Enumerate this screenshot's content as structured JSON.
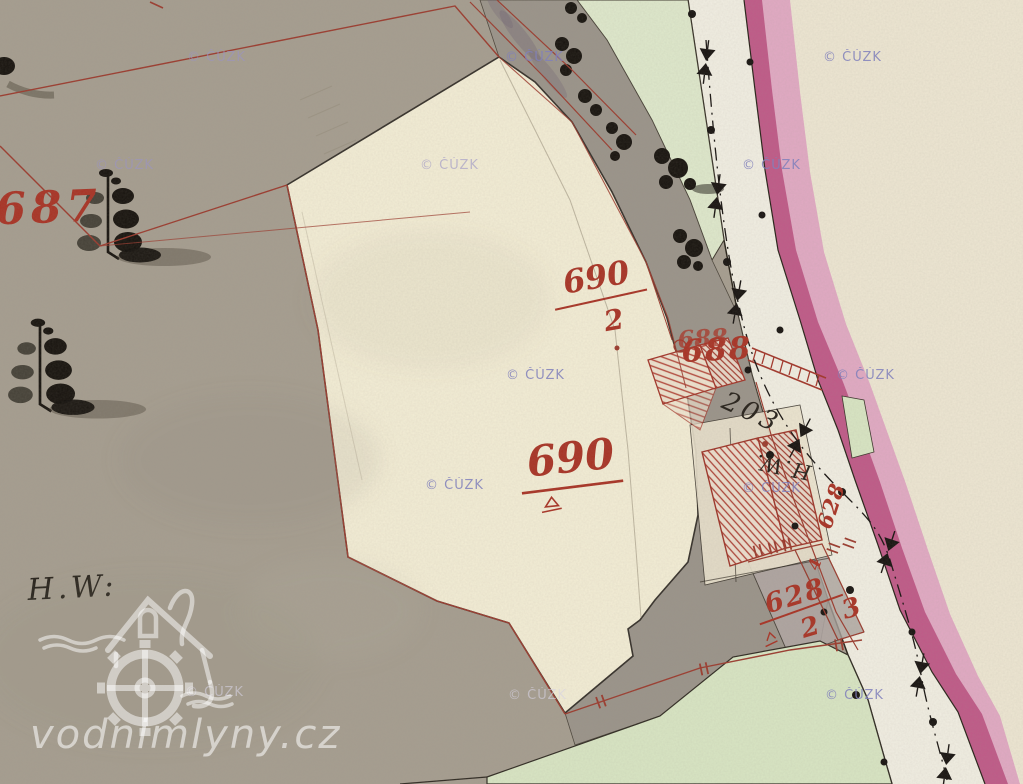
{
  "watermark": {
    "text": "© ČÚZK"
  },
  "logo": {
    "text": "vodnimlyny.cz"
  },
  "labels": {
    "parcel_687": "687",
    "parcel_690_2_num": "690",
    "parcel_690_2_den": "2",
    "parcel_690": "690",
    "parcel_688": "688",
    "parcel_688_echo": "688",
    "parcel_203": "203",
    "parcel_628_num": "628",
    "parcel_628_den_left": "2",
    "parcel_628_den_right": "3",
    "parcel_628_rot": "628",
    "parcel_628_rot_den": "4",
    "hw_upper": "H.W.",
    "hw_lower": "H.W:"
  },
  "colors": {
    "field_gray": "#a69e90",
    "parcel_cream": "#f4eed6",
    "band_gray": "#9b948a",
    "meadow_green": "#dfe9cc",
    "road_white": "#f2efe3",
    "stream_pink_dark": "#c05a88",
    "stream_pink_light": "#e2aac4",
    "margin_cream": "#eee7d3",
    "survey_red": "#9c3b2e",
    "label_red": "#a93325",
    "ink_black": "#24201a",
    "watermark_purple": "#8585bd",
    "logo_white": "#ffffff"
  }
}
